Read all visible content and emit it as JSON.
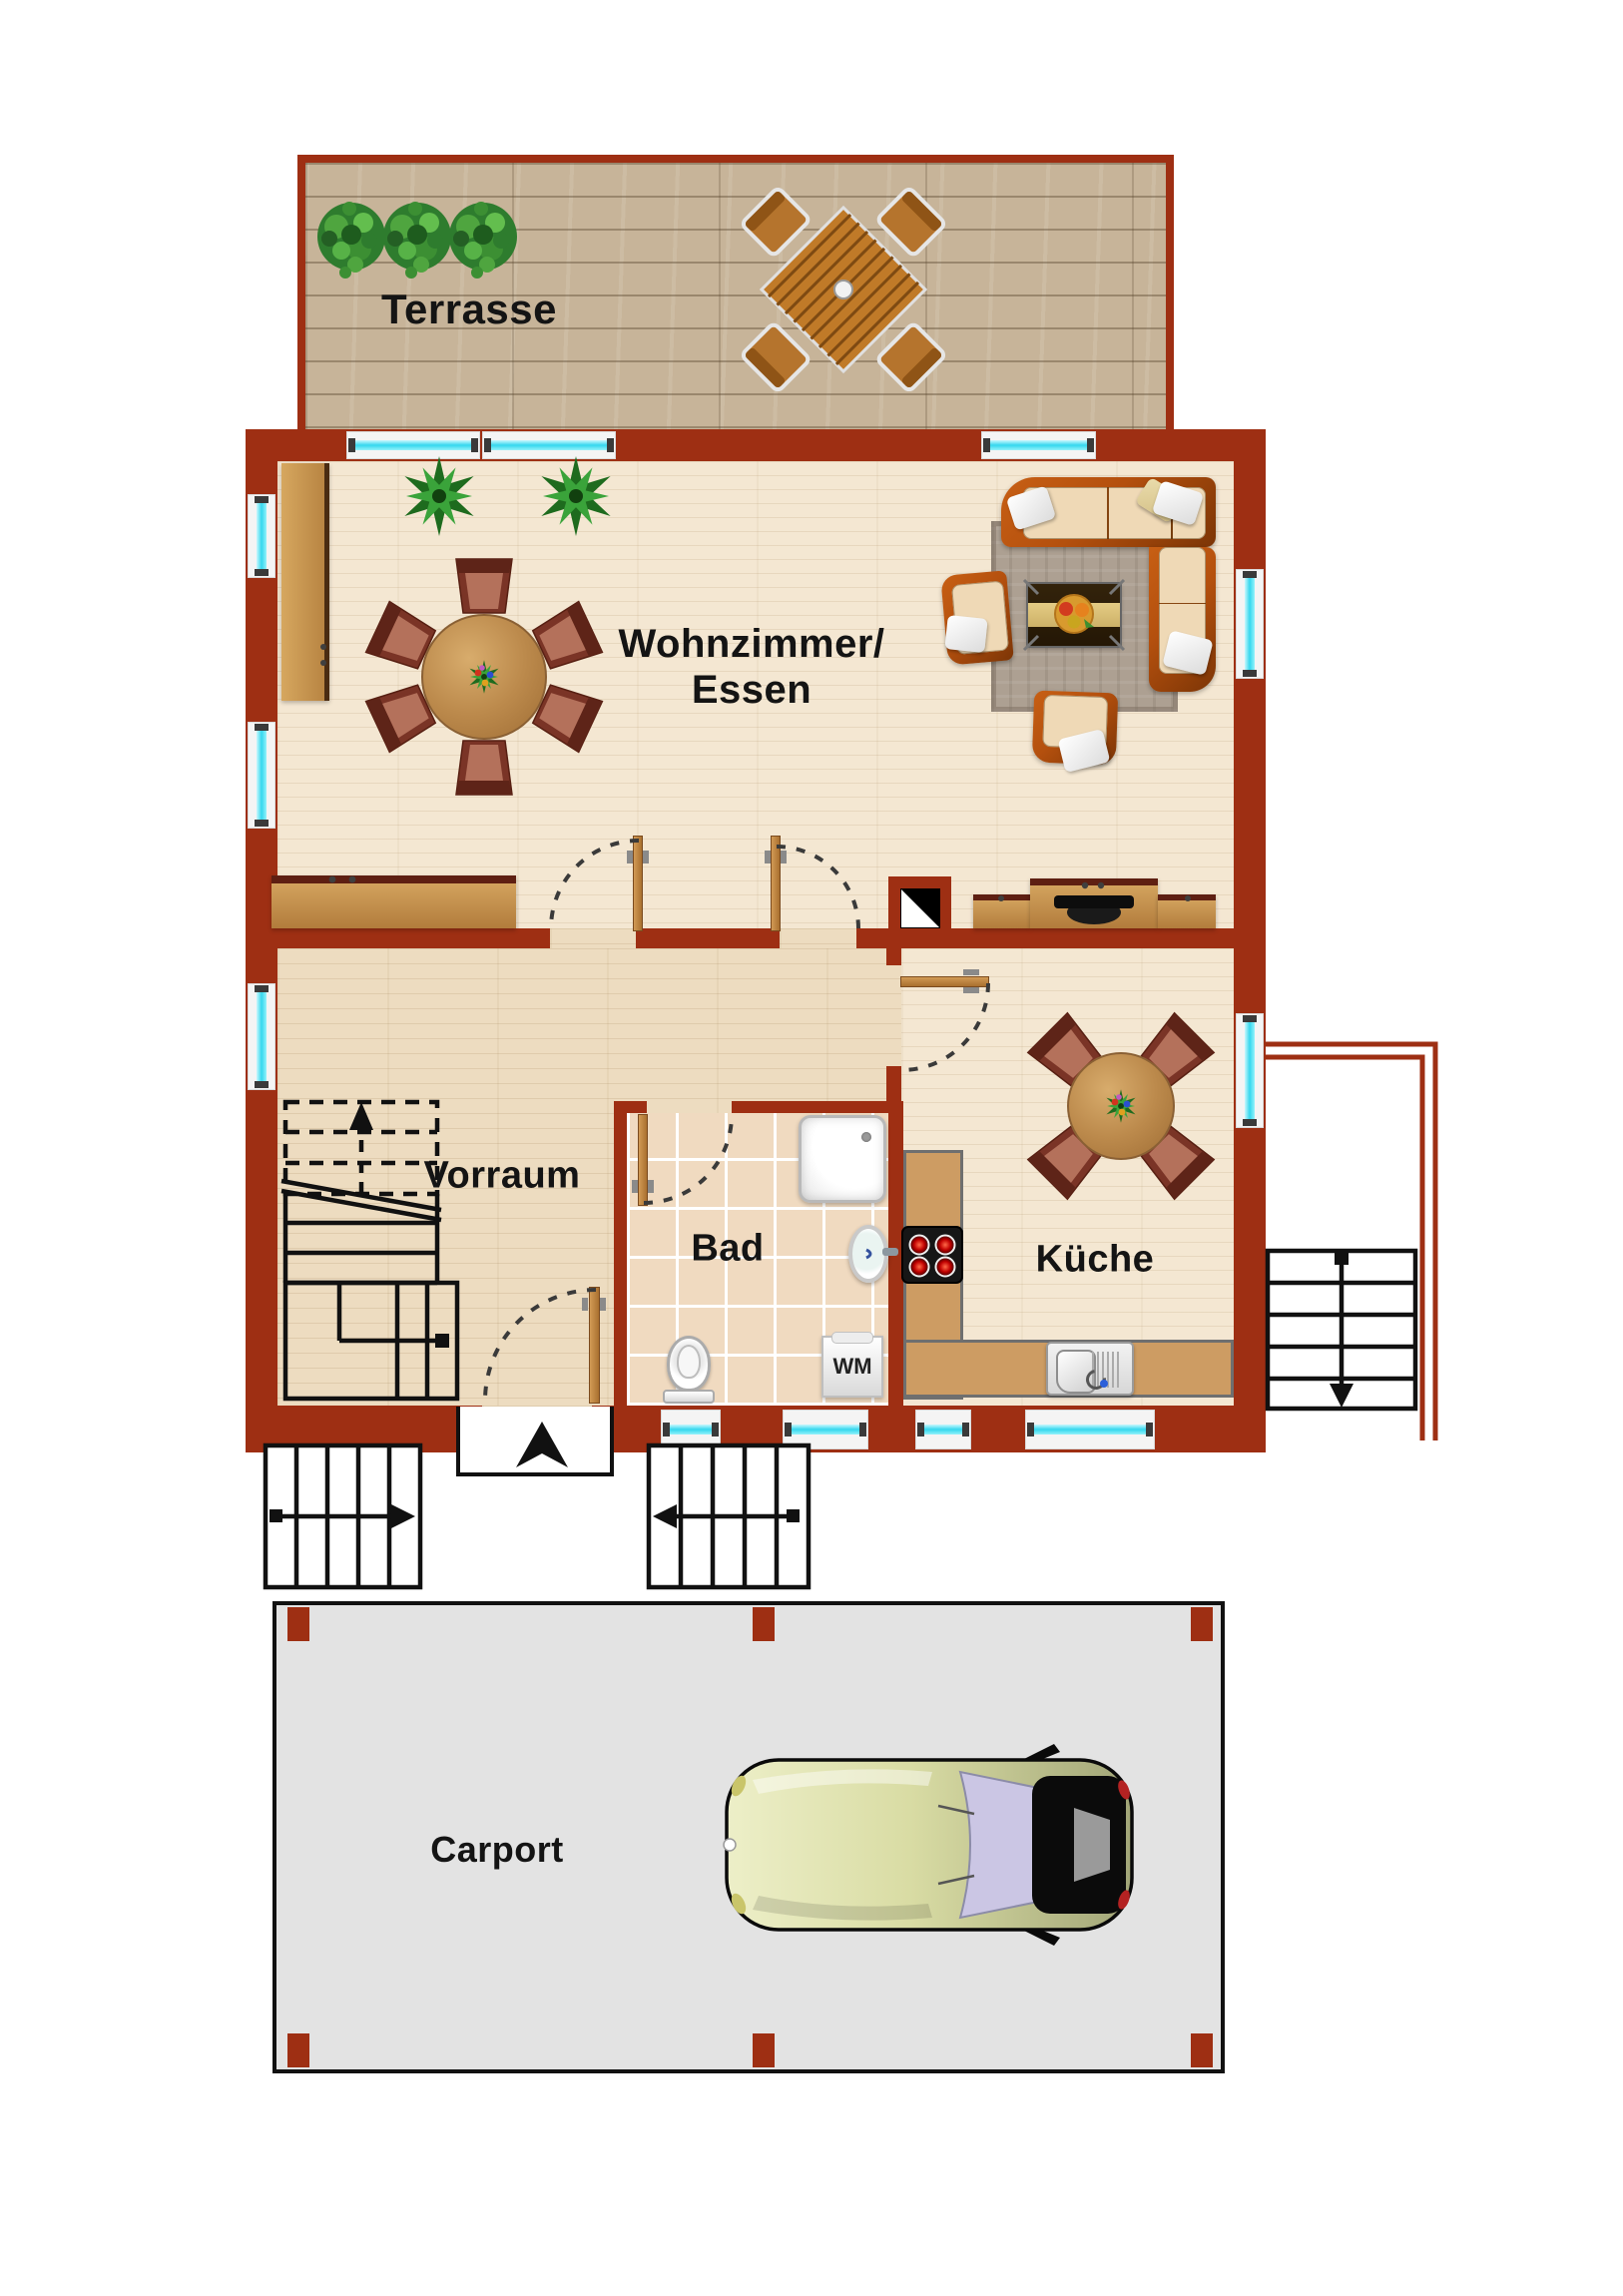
{
  "labels": {
    "terrasse": "Terrasse",
    "wohnzimmer_line1": "Wohnzimmer/",
    "wohnzimmer_line2": "Essen",
    "vorraum": "Vorraum",
    "bad": "Bad",
    "kueche": "Küche",
    "carport": "Carport",
    "washing_machine": "WM"
  },
  "colors": {
    "wall": "#9E2F13",
    "window_glass": "#35D7EE",
    "window_frame": "#F4F4F4",
    "deck": "#C7B499",
    "living_floor": "#F4E7D2",
    "hall_floor": "#EDDCC0",
    "tile": "#F0DAC0",
    "counter": "#CD9C63",
    "door_wood": "#BE8446",
    "furniture_wood": "#C3914F",
    "chair": "#7A3426",
    "sofa_frame": "#B4500E",
    "sofa_cushion": "#EFD9B6",
    "rug": "#ADA092",
    "carport_slab": "#E3E3E3"
  }
}
